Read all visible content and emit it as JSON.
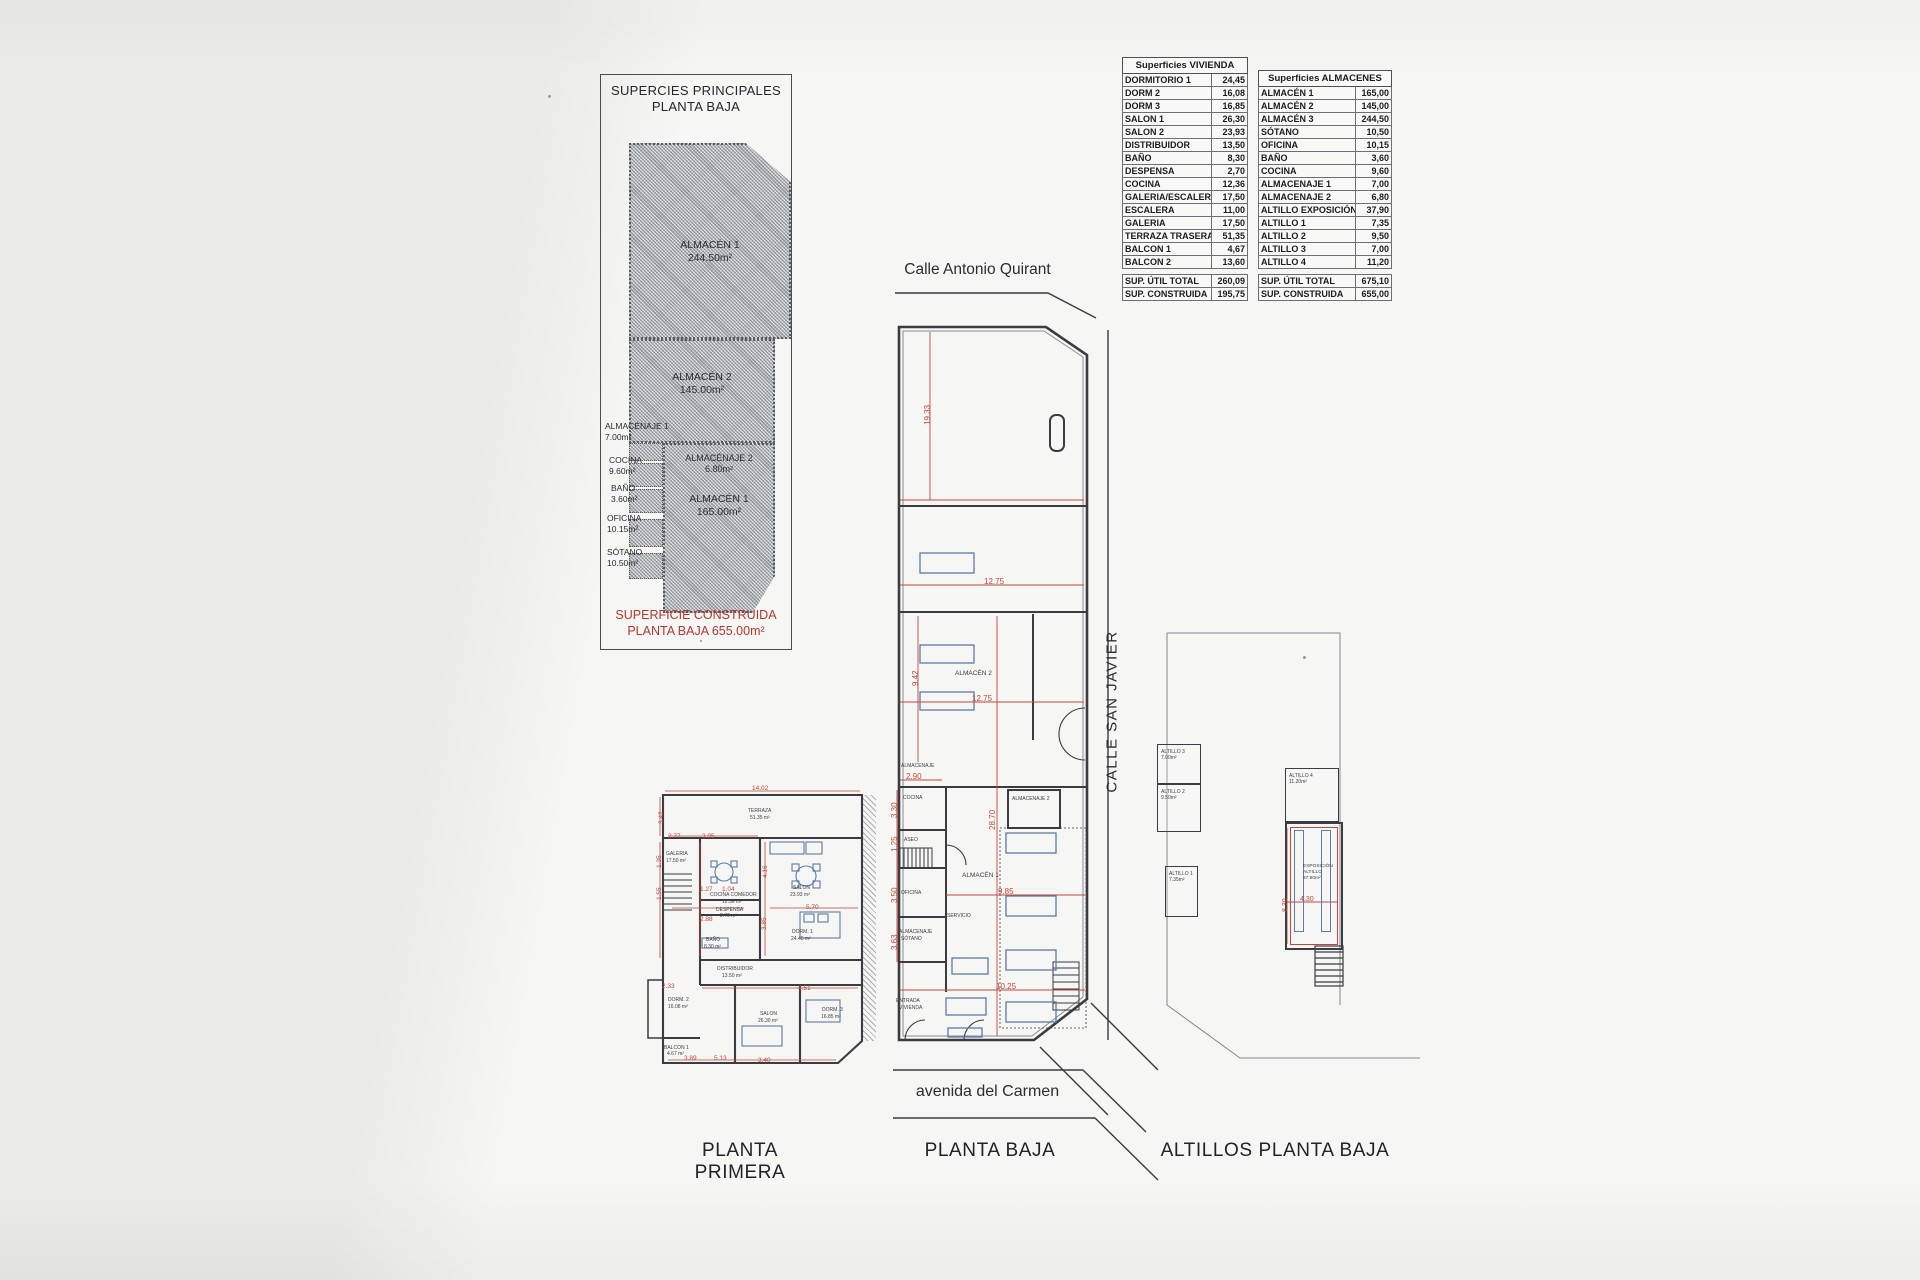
{
  "title_box": {
    "line1": "SUPERCIES PRINCIPALES",
    "line2": "PLANTA BAJA"
  },
  "left_diagram": {
    "almacen1_top": {
      "name": "ALMACÉN 1",
      "area": "244.50m²"
    },
    "almacen2": {
      "name": "ALMACÉN 2",
      "area": "145.00m²"
    },
    "almacenaje2": {
      "name": "ALMACÉNAJE 2",
      "area": "6.80m²"
    },
    "almacen1_bottom": {
      "name": "ALMACÉN 1",
      "area": "165.00m²"
    },
    "side_rooms": [
      {
        "name": "ALMACÉNAJE 1",
        "area": "7.00m²",
        "x": 4,
        "y": 346
      },
      {
        "name": "COCINA",
        "area": "9.60m²",
        "x": 8,
        "y": 380
      },
      {
        "name": "BAÑO",
        "area": "3.60m²",
        "x": 10,
        "y": 408
      },
      {
        "name": "OFICINA",
        "area": "10.15m²",
        "x": 6,
        "y": 438
      },
      {
        "name": "SÓTANO",
        "area": "10.50m²",
        "x": 6,
        "y": 472
      }
    ],
    "footer_line1": "SUPERFICIE CONSTRUIDA",
    "footer_line2": "PLANTA BAJA 655.00m²"
  },
  "tables": {
    "vivienda": {
      "title": "Superficies VIVIENDA",
      "rows": [
        {
          "label": "DORMITORIO 1",
          "value": "24,45"
        },
        {
          "label": "DORM 2",
          "value": "16,08"
        },
        {
          "label": "DORM 3",
          "value": "16,85"
        },
        {
          "label": "SALON 1",
          "value": "26,30"
        },
        {
          "label": "SALON 2",
          "value": "23,93"
        },
        {
          "label": "DISTRIBUIDOR",
          "value": "13,50"
        },
        {
          "label": "BAÑO",
          "value": "8,30"
        },
        {
          "label": "DESPENSA",
          "value": "2,70"
        },
        {
          "label": "COCINA",
          "value": "12,36"
        },
        {
          "label": "GALERIA/ESCALERA",
          "value": "17,50"
        },
        {
          "label": "ESCALERA",
          "value": "11,00"
        },
        {
          "label": "GALERIA",
          "value": "17,50"
        },
        {
          "label": "TERRAZA TRASERA",
          "value": "51,35"
        },
        {
          "label": "BALCON 1",
          "value": "4,67"
        },
        {
          "label": "BALCON 2",
          "value": "13,60"
        }
      ],
      "totals": [
        {
          "label": "SUP. ÚTIL TOTAL",
          "value": "260,09"
        },
        {
          "label": "SUP. CONSTRUIDA",
          "value": "195,75"
        }
      ]
    },
    "almacenes": {
      "title": "Superficies ALMACENES",
      "rows": [
        {
          "label": "ALMACÉN 1",
          "value": "165,00"
        },
        {
          "label": "ALMACÉN 2",
          "value": "145,00"
        },
        {
          "label": "ALMACÉN 3",
          "value": "244,50"
        },
        {
          "label": "SÓTANO",
          "value": "10,50"
        },
        {
          "label": "OFICINA",
          "value": "10,15"
        },
        {
          "label": "BAÑO",
          "value": "3,60"
        },
        {
          "label": "COCINA",
          "value": "9,60"
        },
        {
          "label": "ALMACENAJE 1",
          "value": "7,00"
        },
        {
          "label": "ALMACENAJE 2",
          "value": "6,80"
        },
        {
          "label": "ALTILLO EXPOSICIÓN",
          "value": "37,90"
        },
        {
          "label": "ALTILLO 1",
          "value": "7,35"
        },
        {
          "label": "ALTILLO 2",
          "value": "9,50"
        },
        {
          "label": "ALTILLO 3",
          "value": "7,00"
        },
        {
          "label": "ALTILLO 4",
          "value": "11,20"
        }
      ],
      "totals": [
        {
          "label": "SUP. ÚTIL TOTAL",
          "value": "675,10"
        },
        {
          "label": "SUP. CONSTRUIDA",
          "value": "655,00"
        }
      ]
    }
  },
  "streets": {
    "top": "Calle Antonio Quirant",
    "right": "CALLE SAN JAVIER",
    "bottom": "avenida del Carmen"
  },
  "captions": {
    "left": "PLANTA PRIMERA",
    "center": "PLANTA BAJA",
    "right": "ALTILLOS PLANTA BAJA"
  },
  "planta_baja": {
    "labels": [
      {
        "text": "ALMACÉN 2",
        "x": 955,
        "y": 671
      },
      {
        "text": "ALMACENAJE",
        "x": 901,
        "y": 764,
        "cls": "t5"
      },
      {
        "text": "COCINA",
        "x": 903,
        "y": 796,
        "cls": "t5"
      },
      {
        "text": "ASEO",
        "x": 904,
        "y": 838,
        "cls": "t5"
      },
      {
        "text": "OFICINA",
        "x": 901,
        "y": 891,
        "cls": "t5"
      },
      {
        "text": "ALMACENAJE",
        "x": 899,
        "y": 930,
        "cls": "t5"
      },
      {
        "text": "SÓTANO",
        "x": 901,
        "y": 937,
        "cls": "t5"
      },
      {
        "text": "ALMACENAJE 2",
        "x": 1012,
        "y": 797,
        "cls": "t5"
      },
      {
        "text": "ALMACÉN 1",
        "x": 962,
        "y": 873
      },
      {
        "text": "SERVICIO",
        "x": 947,
        "y": 914,
        "cls": "t5"
      },
      {
        "text": "ENTRADA",
        "x": 896,
        "y": 999,
        "cls": "t5"
      },
      {
        "text": "VIVIENDA",
        "x": 899,
        "y": 1006,
        "cls": "t5"
      }
    ],
    "dims": [
      {
        "text": "19.33",
        "x": 924,
        "y": 425,
        "v": true
      },
      {
        "text": "12.75",
        "x": 984,
        "y": 578
      },
      {
        "text": "9.42",
        "x": 912,
        "y": 686,
        "v": true
      },
      {
        "text": "12.75",
        "x": 972,
        "y": 695
      },
      {
        "text": "2.90",
        "x": 906,
        "y": 773
      },
      {
        "text": "3.30",
        "x": 891,
        "y": 818,
        "v": true
      },
      {
        "text": "1.25",
        "x": 891,
        "y": 852,
        "v": true
      },
      {
        "text": "3.50",
        "x": 891,
        "y": 903,
        "v": true
      },
      {
        "text": "3.63",
        "x": 891,
        "y": 950,
        "v": true
      },
      {
        "text": "28.70",
        "x": 989,
        "y": 830,
        "v": true
      },
      {
        "text": "9.85",
        "x": 998,
        "y": 888
      },
      {
        "text": "10.25",
        "x": 996,
        "y": 983
      }
    ]
  },
  "planta_primera": {
    "labels": [
      {
        "text": "TERRAZA",
        "x": 748,
        "y": 809,
        "cls": "t5"
      },
      {
        "text": "51.35 m²",
        "x": 750,
        "y": 816,
        "cls": "t5"
      },
      {
        "text": "GALERIA",
        "x": 666,
        "y": 852,
        "cls": "t5"
      },
      {
        "text": "17.50 m²",
        "x": 666,
        "y": 859,
        "cls": "t5"
      },
      {
        "text": "COCINA COMEDOR",
        "x": 710,
        "y": 893,
        "cls": "t5"
      },
      {
        "text": "12.36 m²",
        "x": 722,
        "y": 900,
        "cls": "t5"
      },
      {
        "text": "DESPENSA",
        "x": 716,
        "y": 908,
        "cls": "t5"
      },
      {
        "text": "2.70 m²",
        "x": 720,
        "y": 914,
        "cls": "t5"
      },
      {
        "text": "SALON",
        "x": 793,
        "y": 886,
        "cls": "t5"
      },
      {
        "text": "23.93 m²",
        "x": 790,
        "y": 893,
        "cls": "t5"
      },
      {
        "text": "BAÑO",
        "x": 706,
        "y": 938,
        "cls": "t5"
      },
      {
        "text": "8.30 m²",
        "x": 704,
        "y": 945,
        "cls": "t5"
      },
      {
        "text": "DORM. 1",
        "x": 792,
        "y": 930,
        "cls": "t5"
      },
      {
        "text": "24.45 m²",
        "x": 791,
        "y": 937,
        "cls": "t5"
      },
      {
        "text": "DISTRIBUIDOR",
        "x": 717,
        "y": 967,
        "cls": "t5"
      },
      {
        "text": "13.50 m²",
        "x": 722,
        "y": 974,
        "cls": "t5"
      },
      {
        "text": "DORM. 2",
        "x": 668,
        "y": 998,
        "cls": "t5"
      },
      {
        "text": "16.08 m²",
        "x": 668,
        "y": 1005,
        "cls": "t5"
      },
      {
        "text": "SALON",
        "x": 760,
        "y": 1012,
        "cls": "t5"
      },
      {
        "text": "26.30 m²",
        "x": 758,
        "y": 1019,
        "cls": "t5"
      },
      {
        "text": "DORM. 3",
        "x": 822,
        "y": 1008,
        "cls": "t5"
      },
      {
        "text": "16.85 m²",
        "x": 821,
        "y": 1015,
        "cls": "t5"
      },
      {
        "text": "BALCON 1",
        "x": 664,
        "y": 1046,
        "cls": "t5"
      },
      {
        "text": "4.67 m²",
        "x": 667,
        "y": 1052,
        "cls": "t5"
      }
    ],
    "dims": [
      {
        "text": "14.02",
        "x": 752,
        "y": 786
      },
      {
        "text": "3.42",
        "x": 659,
        "y": 824,
        "v": true
      },
      {
        "text": "2.77",
        "x": 668,
        "y": 834
      },
      {
        "text": "3.95",
        "x": 702,
        "y": 834
      },
      {
        "text": "1.35",
        "x": 657,
        "y": 868,
        "v": true
      },
      {
        "text": "4.16",
        "x": 763,
        "y": 878,
        "v": true
      },
      {
        "text": "1.27",
        "x": 700,
        "y": 887
      },
      {
        "text": "1.04",
        "x": 722,
        "y": 887
      },
      {
        "text": "2.88",
        "x": 700,
        "y": 917
      },
      {
        "text": "3.85",
        "x": 762,
        "y": 930,
        "v": true
      },
      {
        "text": "5.70",
        "x": 806,
        "y": 905
      },
      {
        "text": "1.55",
        "x": 657,
        "y": 900,
        "v": true
      },
      {
        "text": "2.33",
        "x": 662,
        "y": 984
      },
      {
        "text": "4.51",
        "x": 798,
        "y": 986
      },
      {
        "text": "3.89",
        "x": 684,
        "y": 1056
      },
      {
        "text": "5.13",
        "x": 714,
        "y": 1056
      },
      {
        "text": "3.40",
        "x": 758,
        "y": 1058
      }
    ]
  },
  "altillos": {
    "boxes": [
      {
        "name": "ALTILLO 3",
        "area": "7.00m²",
        "x": 1157,
        "y": 744,
        "w": 42,
        "h": 38
      },
      {
        "name": "ALTILLO 2",
        "area": "9.50m²",
        "x": 1157,
        "y": 784,
        "w": 42,
        "h": 46
      },
      {
        "name": "ALTILLO 1",
        "area": "7.35m²",
        "x": 1165,
        "y": 866,
        "w": 31,
        "h": 49
      },
      {
        "name": "ALTILLO 4",
        "area": "11.20m²",
        "x": 1285,
        "y": 768,
        "w": 52,
        "h": 52
      }
    ],
    "exposicion": {
      "line1": "EXPOSICIÓN",
      "line2": "ALTILLO",
      "line3": "37.90m²"
    },
    "dims": [
      {
        "text": "4.30",
        "x": 1300,
        "y": 896
      },
      {
        "text": "8.30",
        "x": 1282,
        "y": 912,
        "v": true
      }
    ]
  }
}
